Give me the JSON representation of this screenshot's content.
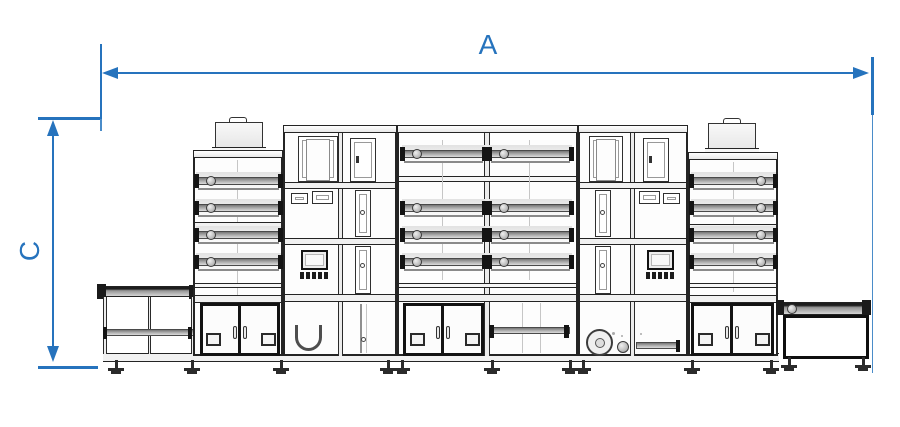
{
  "diagram": {
    "labels": {
      "width_dim": "A",
      "height_dim": "C"
    },
    "colors": {
      "dimension_blue": "#2673bd",
      "line_black": "#242424"
    }
  }
}
